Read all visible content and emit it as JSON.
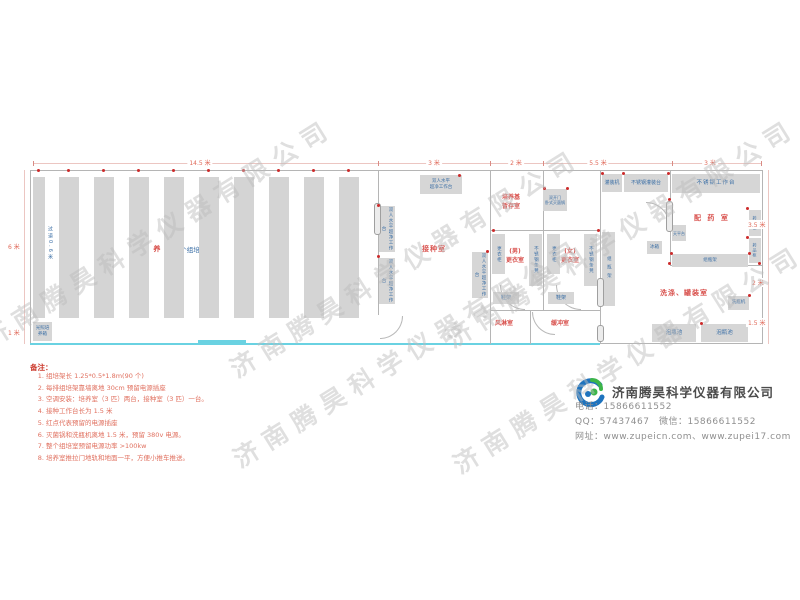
{
  "colors": {
    "accent_red": "#d9534f",
    "label_blue": "#3a6ea5",
    "wall_gray": "#b5b5b5",
    "wall_cyan": "#6ad2e2",
    "logo_blue": "#1e73be",
    "logo_green": "#3cb54a"
  },
  "watermark": {
    "text": "济南腾昊科学仪器有限公司"
  },
  "dims": {
    "top_total": "14.5 米",
    "top_seed": "3 米",
    "top_medium": "2 米",
    "top_wash": "5.5 米",
    "top_dispense": "3 米",
    "left_upper": "6 米",
    "left_lower": "1 米",
    "right_upper": "3.5 米",
    "right_mid": "2 米",
    "right_lower": "1.5 米"
  },
  "rooms": {
    "culture": {
      "name": "培 养 室",
      "racks": "90个组培架",
      "aisle": "过道0.6米",
      "incubator": "光照培养箱"
    },
    "seed": {
      "name": "接种室",
      "bench_l1": "双人水平",
      "bench_l2": "超净工作台",
      "bench_full": "双人水平超净工作台"
    },
    "medium": {
      "name_l1": "培养基",
      "name_l2": "暂存室",
      "sterilizer_l1": "双开门",
      "sterilizer_l2": "卧式灭菌锅"
    },
    "changing": {
      "men": "(男)",
      "women": "(女)",
      "room": "更衣室",
      "locker": "更衣柜",
      "bench": "不锈钢条凳",
      "shoe_rack": "鞋架"
    },
    "air_shower": {
      "name": "风淋室"
    },
    "buffer": {
      "name": "缓冲室"
    },
    "dispense": {
      "name": "配 药 室",
      "work_table": "不锈钢工作台",
      "cabinet": "药品柜",
      "balance": "天平台",
      "fridge": "冰箱",
      "bottle_rack": "组瓶架"
    },
    "wash": {
      "name": "洗涤、罐装室",
      "filler": "灌装机",
      "fill_table": "不锈钢灌装台",
      "washer": "洗瓶机",
      "soak_pool": "泡瓶池",
      "tall_rack": "组瓶架"
    }
  },
  "notes": {
    "title": "备注：",
    "items": [
      "组培架长 1.25*0.5*1.8m(90 个)",
      "每排组培架靠墙离地 30cm 预留电源插座",
      "空调安装：培养室（3 匹）两台，接种室（3 匹）一台。",
      "接种工作台长为 1.5 米",
      "红点代表预留的电源插座",
      "灭菌锅和洗瓶机离地 1.5 米，预留 380v 电源。",
      "整个组培室预留电源功率 >100kw",
      "培养室推拉门地轨和地面一平，方便小推车推送。"
    ]
  },
  "company": {
    "name": "济南腾昊科学仪器有限公司",
    "phone": "电话：15866611552",
    "qq_wechat": "QQ：57437467　微信：15866611552",
    "web": "网址：www.zupeicn.com、www.zupei17.com"
  }
}
